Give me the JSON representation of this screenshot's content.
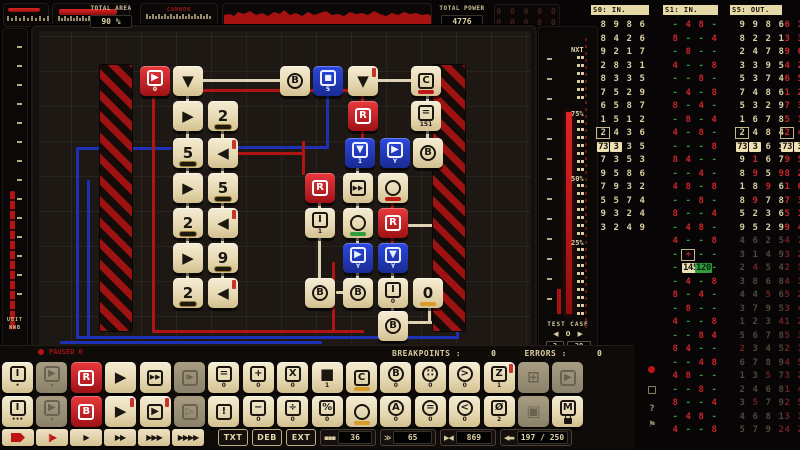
{
  "top_bar": {
    "area": {
      "label": "TOTAL AREA",
      "value": "90 %"
    },
    "meter2_label": "CANNON",
    "power": {
      "label": "TOTAL POWER",
      "value": "4776"
    },
    "dim_display": [
      "0 0 0 0 0",
      "0 0 0 0 0"
    ]
  },
  "left_strip": {
    "line1": "UBIT",
    "line2": "NWB"
  },
  "right_meter": {
    "next_label": "NXT",
    "pct_labels": [
      "75%",
      "50%",
      "25%"
    ],
    "test_case": {
      "label": "TEST CASE",
      "prev": "◀",
      "value": "0",
      "next": "▶",
      "done": "2",
      "total": "20"
    }
  },
  "status_row": {
    "state": "PAUSED 0",
    "breakpoints_label": "BREAKPOINTS :",
    "breakpoints_value": "0",
    "errors_label": "ERRORS :",
    "errors_value": "0"
  },
  "board": {
    "tiles": [
      {
        "x": 140,
        "y": 66,
        "k": "r",
        "f": "box",
        "g": "▶",
        "s": "0"
      },
      {
        "x": 173,
        "y": 66,
        "k": "c",
        "g": "▼"
      },
      {
        "x": 280,
        "y": 66,
        "k": "c",
        "f": "circ",
        "g": "B"
      },
      {
        "x": 313,
        "y": 66,
        "k": "b",
        "f": "box",
        "g": "■",
        "s": "5"
      },
      {
        "x": 348,
        "y": 66,
        "k": "c",
        "g": "▼",
        "acc": 1
      },
      {
        "x": 411,
        "y": 66,
        "k": "c",
        "f": "box",
        "g": "C",
        "bar": "red"
      },
      {
        "x": 173,
        "y": 101,
        "k": "c",
        "g": "▶"
      },
      {
        "x": 208,
        "y": 101,
        "k": "c",
        "g": "2",
        "bar": "dark"
      },
      {
        "x": 348,
        "y": 101,
        "k": "r",
        "f": "box",
        "g": "R"
      },
      {
        "x": 411,
        "y": 101,
        "k": "c",
        "f": "box",
        "g": "=",
        "s": "151"
      },
      {
        "x": 173,
        "y": 138,
        "k": "c",
        "g": "5",
        "bar": "dark"
      },
      {
        "x": 208,
        "y": 138,
        "k": "c",
        "g": "◀",
        "acc": 1
      },
      {
        "x": 345,
        "y": 138,
        "k": "b",
        "f": "box",
        "g": "▼",
        "s": "1"
      },
      {
        "x": 380,
        "y": 138,
        "k": "b",
        "f": "box",
        "g": "▶",
        "s": "Y"
      },
      {
        "x": 413,
        "y": 138,
        "k": "c",
        "f": "circ",
        "g": "B"
      },
      {
        "x": 173,
        "y": 173,
        "k": "c",
        "g": "▶"
      },
      {
        "x": 208,
        "y": 173,
        "k": "c",
        "g": "5",
        "bar": "dark"
      },
      {
        "x": 305,
        "y": 173,
        "k": "r",
        "f": "box",
        "g": "R"
      },
      {
        "x": 343,
        "y": 173,
        "k": "c",
        "f": "box",
        "g": "▶▶"
      },
      {
        "x": 378,
        "y": 173,
        "k": "c",
        "f": "circ",
        "g": "",
        "bar": "red"
      },
      {
        "x": 173,
        "y": 208,
        "k": "c",
        "g": "2",
        "bar": "dark"
      },
      {
        "x": 208,
        "y": 208,
        "k": "c",
        "g": "◀",
        "acc": 1
      },
      {
        "x": 305,
        "y": 208,
        "k": "c",
        "f": "box",
        "g": "I",
        "s": "1"
      },
      {
        "x": 343,
        "y": 208,
        "k": "c",
        "f": "circ",
        "g": "",
        "bar": "green"
      },
      {
        "x": 378,
        "y": 208,
        "k": "r",
        "f": "box",
        "g": "R"
      },
      {
        "x": 173,
        "y": 243,
        "k": "c",
        "g": "▶"
      },
      {
        "x": 208,
        "y": 243,
        "k": "c",
        "g": "9",
        "bar": "dark"
      },
      {
        "x": 343,
        "y": 243,
        "k": "b",
        "f": "box",
        "g": "▶",
        "s": "Y"
      },
      {
        "x": 378,
        "y": 243,
        "k": "b",
        "f": "box",
        "g": "▼",
        "s": "Y"
      },
      {
        "x": 173,
        "y": 278,
        "k": "c",
        "g": "2",
        "bar": "dark"
      },
      {
        "x": 208,
        "y": 278,
        "k": "c",
        "g": "◀",
        "acc": 1
      },
      {
        "x": 305,
        "y": 278,
        "k": "c",
        "f": "circ",
        "g": "B"
      },
      {
        "x": 343,
        "y": 278,
        "k": "c",
        "f": "circ",
        "g": "B"
      },
      {
        "x": 378,
        "y": 278,
        "k": "c",
        "f": "box",
        "g": "I",
        "s": "0"
      },
      {
        "x": 413,
        "y": 278,
        "k": "c",
        "g": "0",
        "bar": "gold"
      },
      {
        "x": 378,
        "y": 311,
        "k": "c",
        "f": "circ",
        "g": "B"
      }
    ]
  },
  "panels": {
    "s0": {
      "title": "S0: IN.",
      "x": 591,
      "w": 58,
      "style": "cream",
      "boxed": [
        [
          8,
          0
        ]
      ],
      "hl": {
        "row": 9,
        "cells": {
          "0": "73",
          "1": "3"
        }
      },
      "rows": [
        [
          "8",
          "9",
          "8",
          "6"
        ],
        [
          "8",
          "4",
          "2",
          "6"
        ],
        [
          "9",
          "2",
          "1",
          "7"
        ],
        [
          "2",
          "8",
          "3",
          "1"
        ],
        [
          "8",
          "3",
          "3",
          "5"
        ],
        [
          "7",
          "5",
          "2",
          "9"
        ],
        [
          "6",
          "5",
          "8",
          "7"
        ],
        [
          "1",
          "5",
          "1",
          "2"
        ],
        [
          "2",
          "4",
          "3",
          "6"
        ],
        [
          "73",
          "3",
          "3",
          "5"
        ],
        [
          "7",
          "3",
          "5",
          "3"
        ],
        [
          "9",
          "5",
          "8",
          "6"
        ],
        [
          "7",
          "9",
          "3",
          "2"
        ],
        [
          "5",
          "5",
          "7",
          "4"
        ],
        [
          "9",
          "3",
          "2",
          "4"
        ],
        [
          "3",
          "2",
          "4",
          "9"
        ]
      ]
    },
    "s1": {
      "title": "S1: IN.",
      "x": 663,
      "w": 55,
      "style": "s1",
      "boxed": [
        [
          17,
          1
        ]
      ],
      "hl": {
        "row": 18,
        "cells": {
          "1": "145",
          "2": "120"
        },
        "green": [
          2
        ]
      },
      "rows": [
        [
          "-",
          "4",
          "8",
          "-"
        ],
        [
          "8",
          "-",
          "-",
          "4"
        ],
        [
          "-",
          "8",
          "-",
          "-"
        ],
        [
          "4",
          "-",
          "-",
          "8"
        ],
        [
          "-",
          "-",
          "8",
          "-"
        ],
        [
          "-",
          "4",
          "-",
          "8"
        ],
        [
          "8",
          "-",
          "4",
          "-"
        ],
        [
          "-",
          "8",
          "-",
          "4"
        ],
        [
          "4",
          "-",
          "8",
          "-"
        ],
        [
          "-",
          "-",
          "-",
          "8"
        ],
        [
          "8",
          "4",
          "-",
          "-"
        ],
        [
          "-",
          "-",
          "4",
          "-"
        ],
        [
          "4",
          "8",
          "-",
          "8"
        ],
        [
          "-",
          "-",
          "8",
          "-"
        ],
        [
          "8",
          "-",
          "-",
          "4"
        ],
        [
          "-",
          "4",
          "8",
          "-"
        ],
        [
          "4",
          "-",
          "-",
          "8"
        ],
        [
          "-",
          "+",
          "-",
          "-"
        ],
        [
          "-",
          "145",
          "120",
          "-"
        ],
        [
          "-",
          "4",
          "-",
          "8"
        ],
        [
          "8",
          "-",
          "4",
          "-"
        ],
        [
          "-",
          "8",
          "-",
          "-"
        ],
        [
          "4",
          "-",
          "-",
          "8"
        ],
        [
          "-",
          "-",
          "8",
          "4"
        ],
        [
          "8",
          "4",
          "-",
          "-"
        ],
        [
          "-",
          "-",
          "4",
          "8"
        ],
        [
          "4",
          "8",
          "-",
          "-"
        ],
        [
          "-",
          "-",
          "8",
          "-"
        ],
        [
          "8",
          "-",
          "-",
          "4"
        ],
        [
          "-",
          "4",
          "8",
          "-"
        ],
        [
          "4",
          "-",
          "-",
          "8"
        ]
      ]
    },
    "s5": {
      "title": "S5: OUT.",
      "x": 730,
      "w": 52,
      "style": "cream",
      "dim_after": 15,
      "boxed": [
        [
          8,
          0
        ]
      ],
      "hl": {
        "row": 9,
        "cells": {
          "0": "73",
          "1": "3"
        }
      },
      "red_cells": [
        [
          10,
          1
        ],
        [
          11,
          1
        ],
        [
          11,
          3
        ],
        [
          12,
          2
        ],
        [
          13,
          1
        ],
        [
          18,
          1
        ],
        [
          20,
          2
        ],
        [
          22,
          3
        ],
        [
          24,
          0
        ],
        [
          26,
          2
        ],
        [
          28,
          1
        ],
        [
          30,
          3
        ]
      ],
      "rows": [
        [
          "9",
          "9",
          "8",
          "6"
        ],
        [
          "8",
          "2",
          "2",
          "1"
        ],
        [
          "2",
          "4",
          "7",
          "8"
        ],
        [
          "3",
          "3",
          "9",
          "5"
        ],
        [
          "5",
          "3",
          "7",
          "4"
        ],
        [
          "7",
          "4",
          "8",
          "6"
        ],
        [
          "5",
          "3",
          "2",
          "9"
        ],
        [
          "1",
          "6",
          "7",
          "8"
        ],
        [
          "2",
          "4",
          "8",
          "4"
        ],
        [
          "73",
          "3",
          "6",
          "1"
        ],
        [
          "9",
          "1",
          "6",
          "7"
        ],
        [
          "8",
          "9",
          "5",
          "9"
        ],
        [
          "1",
          "8",
          "9",
          "6"
        ],
        [
          "8",
          "9",
          "7",
          "8"
        ],
        [
          "5",
          "2",
          "3",
          "6"
        ],
        [
          "9",
          "5",
          "2",
          "9"
        ],
        [
          "4",
          "6",
          "2",
          "5"
        ],
        [
          "3",
          "1",
          "4",
          "9"
        ],
        [
          "2",
          "4",
          "5",
          "4"
        ],
        [
          "3",
          "8",
          "6",
          "8"
        ],
        [
          "4",
          "4",
          "5",
          "6"
        ],
        [
          "3",
          "7",
          "9",
          "5"
        ],
        [
          "1",
          "2",
          "3",
          "4"
        ],
        [
          "5",
          "6",
          "7",
          "8"
        ],
        [
          "2",
          "3",
          "4",
          "5"
        ],
        [
          "6",
          "7",
          "8",
          "9"
        ],
        [
          "1",
          "3",
          "5",
          "7"
        ],
        [
          "2",
          "4",
          "6",
          "8"
        ],
        [
          "3",
          "5",
          "7",
          "9"
        ],
        [
          "4",
          "6",
          "8",
          "1"
        ],
        [
          "5",
          "7",
          "9",
          "2"
        ]
      ]
    },
    "edge": {
      "title": "",
      "x": 778,
      "w": 22,
      "style": "edge",
      "dim_after": 15,
      "boxed": [
        [
          8,
          0
        ]
      ],
      "cols": [
        781,
        794
      ],
      "hl": {
        "row": 9,
        "cells": {
          "0": "73",
          "1": "3"
        }
      },
      "rows": [
        [
          "6",
          "1"
        ],
        [
          "3",
          "3"
        ],
        [
          "9",
          "6"
        ],
        [
          "4",
          "2"
        ],
        [
          "6",
          "5"
        ],
        [
          "1",
          "2"
        ],
        [
          "7",
          "3"
        ],
        [
          "5",
          "1"
        ],
        [
          "2",
          "4"
        ],
        [
          "73",
          "3"
        ],
        [
          "9",
          "5"
        ],
        [
          "8",
          "2"
        ],
        [
          "1",
          "6"
        ],
        [
          "7",
          "3"
        ],
        [
          "5",
          "1"
        ],
        [
          "9",
          "4"
        ],
        [
          "4",
          "7"
        ],
        [
          "3",
          "2"
        ],
        [
          "2",
          "3"
        ],
        [
          "4",
          "1"
        ],
        [
          "5",
          "2"
        ],
        [
          "3",
          "4"
        ],
        [
          "1",
          "2"
        ],
        [
          "5",
          "3"
        ],
        [
          "2",
          "1"
        ],
        [
          "4",
          "5"
        ],
        [
          "3",
          "2"
        ],
        [
          "1",
          "4"
        ],
        [
          "2",
          "5"
        ],
        [
          "3",
          "1"
        ],
        [
          "4",
          "2"
        ]
      ]
    }
  },
  "toolbar": {
    "rows": [
      [
        {
          "f": "box",
          "g": "I",
          "s": "•"
        },
        {
          "f": "box",
          "g": "▶",
          "sg": "▾",
          "dim": 1
        },
        {
          "k": "r",
          "f": "box",
          "g": "R"
        },
        {
          "g": "▶"
        },
        {
          "f": "box",
          "g": "▶▶"
        },
        {
          "f": "box",
          "g": "I▶",
          "dim": 1
        },
        {
          "f": "box",
          "g": "=",
          "s": "0"
        },
        {
          "f": "box",
          "g": "+",
          "s": "0"
        },
        {
          "f": "box",
          "g": "X",
          "s": "0"
        },
        {
          "g": "■",
          "s": "1"
        },
        {
          "f": "box",
          "g": "C",
          "bar": "gold"
        },
        {
          "f": "circ",
          "g": "B",
          "s": "0"
        },
        {
          "f": "circ",
          "g": "∷",
          "s": "0"
        },
        {
          "f": "circ",
          "g": ">",
          "s": "0"
        },
        {
          "f": "box",
          "g": "Z",
          "s": "1",
          "acc": 1
        },
        {
          "g": "⊞",
          "dim": 1
        },
        {
          "f": "box",
          "g": "▶",
          "dim": 1
        }
      ],
      [
        {
          "f": "box",
          "g": "I",
          "s": "•••"
        },
        {
          "f": "box",
          "g": "▶",
          "sg": "▾",
          "dim": 1
        },
        {
          "k": "r",
          "f": "box",
          "g": "B"
        },
        {
          "g": "▶",
          "acc": 1
        },
        {
          "f": "box",
          "g": "▶",
          "acc": 1
        },
        {
          "f": "box",
          "g": "▷",
          "dim": 1
        },
        {
          "f": "box",
          "g": "!"
        },
        {
          "f": "box",
          "g": "−",
          "s": "0"
        },
        {
          "f": "box",
          "g": "÷",
          "s": "0"
        },
        {
          "f": "box",
          "g": "%",
          "s": "0"
        },
        {
          "f": "circ",
          "g": "",
          "bar": "gold"
        },
        {
          "f": "circ",
          "g": "A",
          "s": "0"
        },
        {
          "f": "circ",
          "g": "=",
          "s": "0"
        },
        {
          "f": "circ",
          "g": "<",
          "s": "0"
        },
        {
          "f": "box",
          "g": "Ø",
          "s": "2"
        },
        {
          "g": "▣",
          "dim": 1
        },
        {
          "f": "box",
          "g": "M",
          "sg": "lock"
        }
      ]
    ]
  },
  "controls": {
    "halt_icon": "flag",
    "step_icon": "‖▶",
    "speed_buttons": [
      "▶",
      "▶▶",
      "▶▶▶",
      "▶▶▶▶"
    ],
    "text_buttons": [
      "TXT",
      "DEB",
      "EXT"
    ],
    "readouts": [
      {
        "icon": "▪▪▪",
        "value": "36"
      },
      {
        "icon": "≫",
        "value": "65"
      },
      {
        "icon": "▶◀",
        "value": "869"
      },
      {
        "icon": "◀▬",
        "value": "197 / 250"
      }
    ]
  },
  "side_icons": {
    "help": "?",
    "flag": "⚑"
  }
}
